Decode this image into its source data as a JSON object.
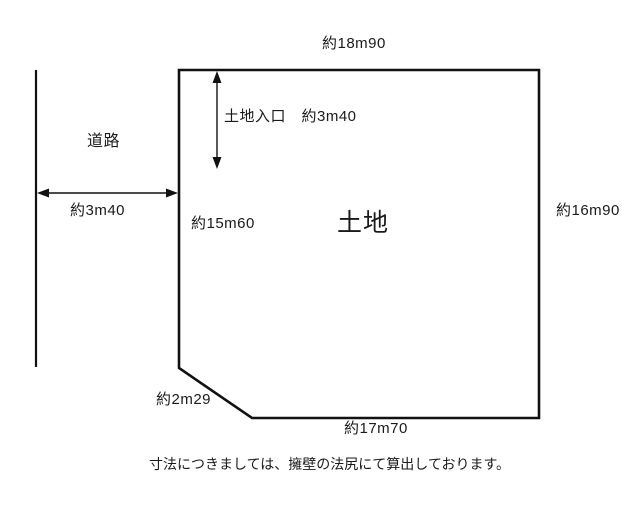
{
  "diagram": {
    "labels": {
      "top_side": "約18m90",
      "entrance": "土地入口　約3m40",
      "road": "道路",
      "road_width": "約3m40",
      "left_side": "約15m60",
      "land": "土地",
      "right_side": "約16m90",
      "corner_cut": "約2m29",
      "bottom_side": "約17m70"
    },
    "footnote": "寸法につきましては、擁壁の法尻にて算出しております。",
    "colors": {
      "line": "#111111",
      "background": "#ffffff",
      "text": "#1a1a1a"
    }
  }
}
